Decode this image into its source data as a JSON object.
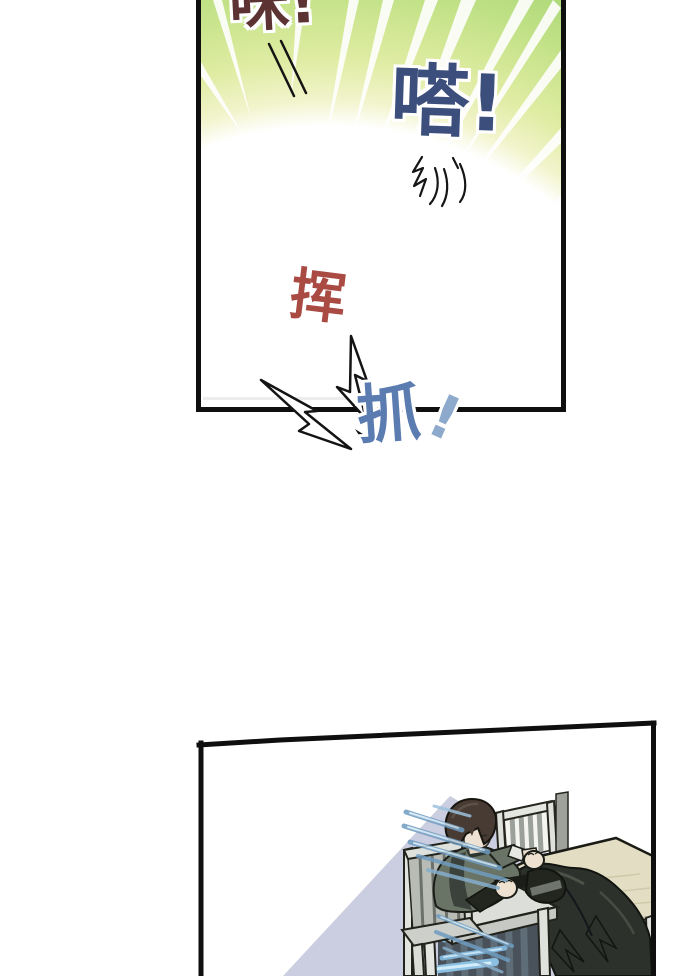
{
  "comic": {
    "panel_top": {
      "sfx_mi": "咪!",
      "sfx_da": "嗒!",
      "sfx_hui": "挥"
    },
    "gutter": {
      "sfx_zhua": "抓",
      "sfx_zhua_exclaim": "!"
    },
    "colors": {
      "sfx_mi": "#5c3332",
      "sfx_da": "#3c4e7c",
      "sfx_hui": "#a94a43",
      "sfx_zhua": "#5a7cb0",
      "sfx_zhua_exclaim": "#8da9cb",
      "burst_green_outer": "#9cd06d",
      "burst_green_mid": "#c8e48c",
      "burst_center_white": "#ffffff",
      "panel_border": "#0f0f0f",
      "wall_shadow_lavender": "#c8cade",
      "table_wood_tan": "#e3ddc3",
      "side_table_grey": "#dcdeda",
      "cloth_dark": "#2d312b",
      "motion_line_blue": "#6f9cc0",
      "hair_brown": "#473b33",
      "jacket_olive": "#6a7466",
      "skin": "#ecdfcd"
    }
  }
}
